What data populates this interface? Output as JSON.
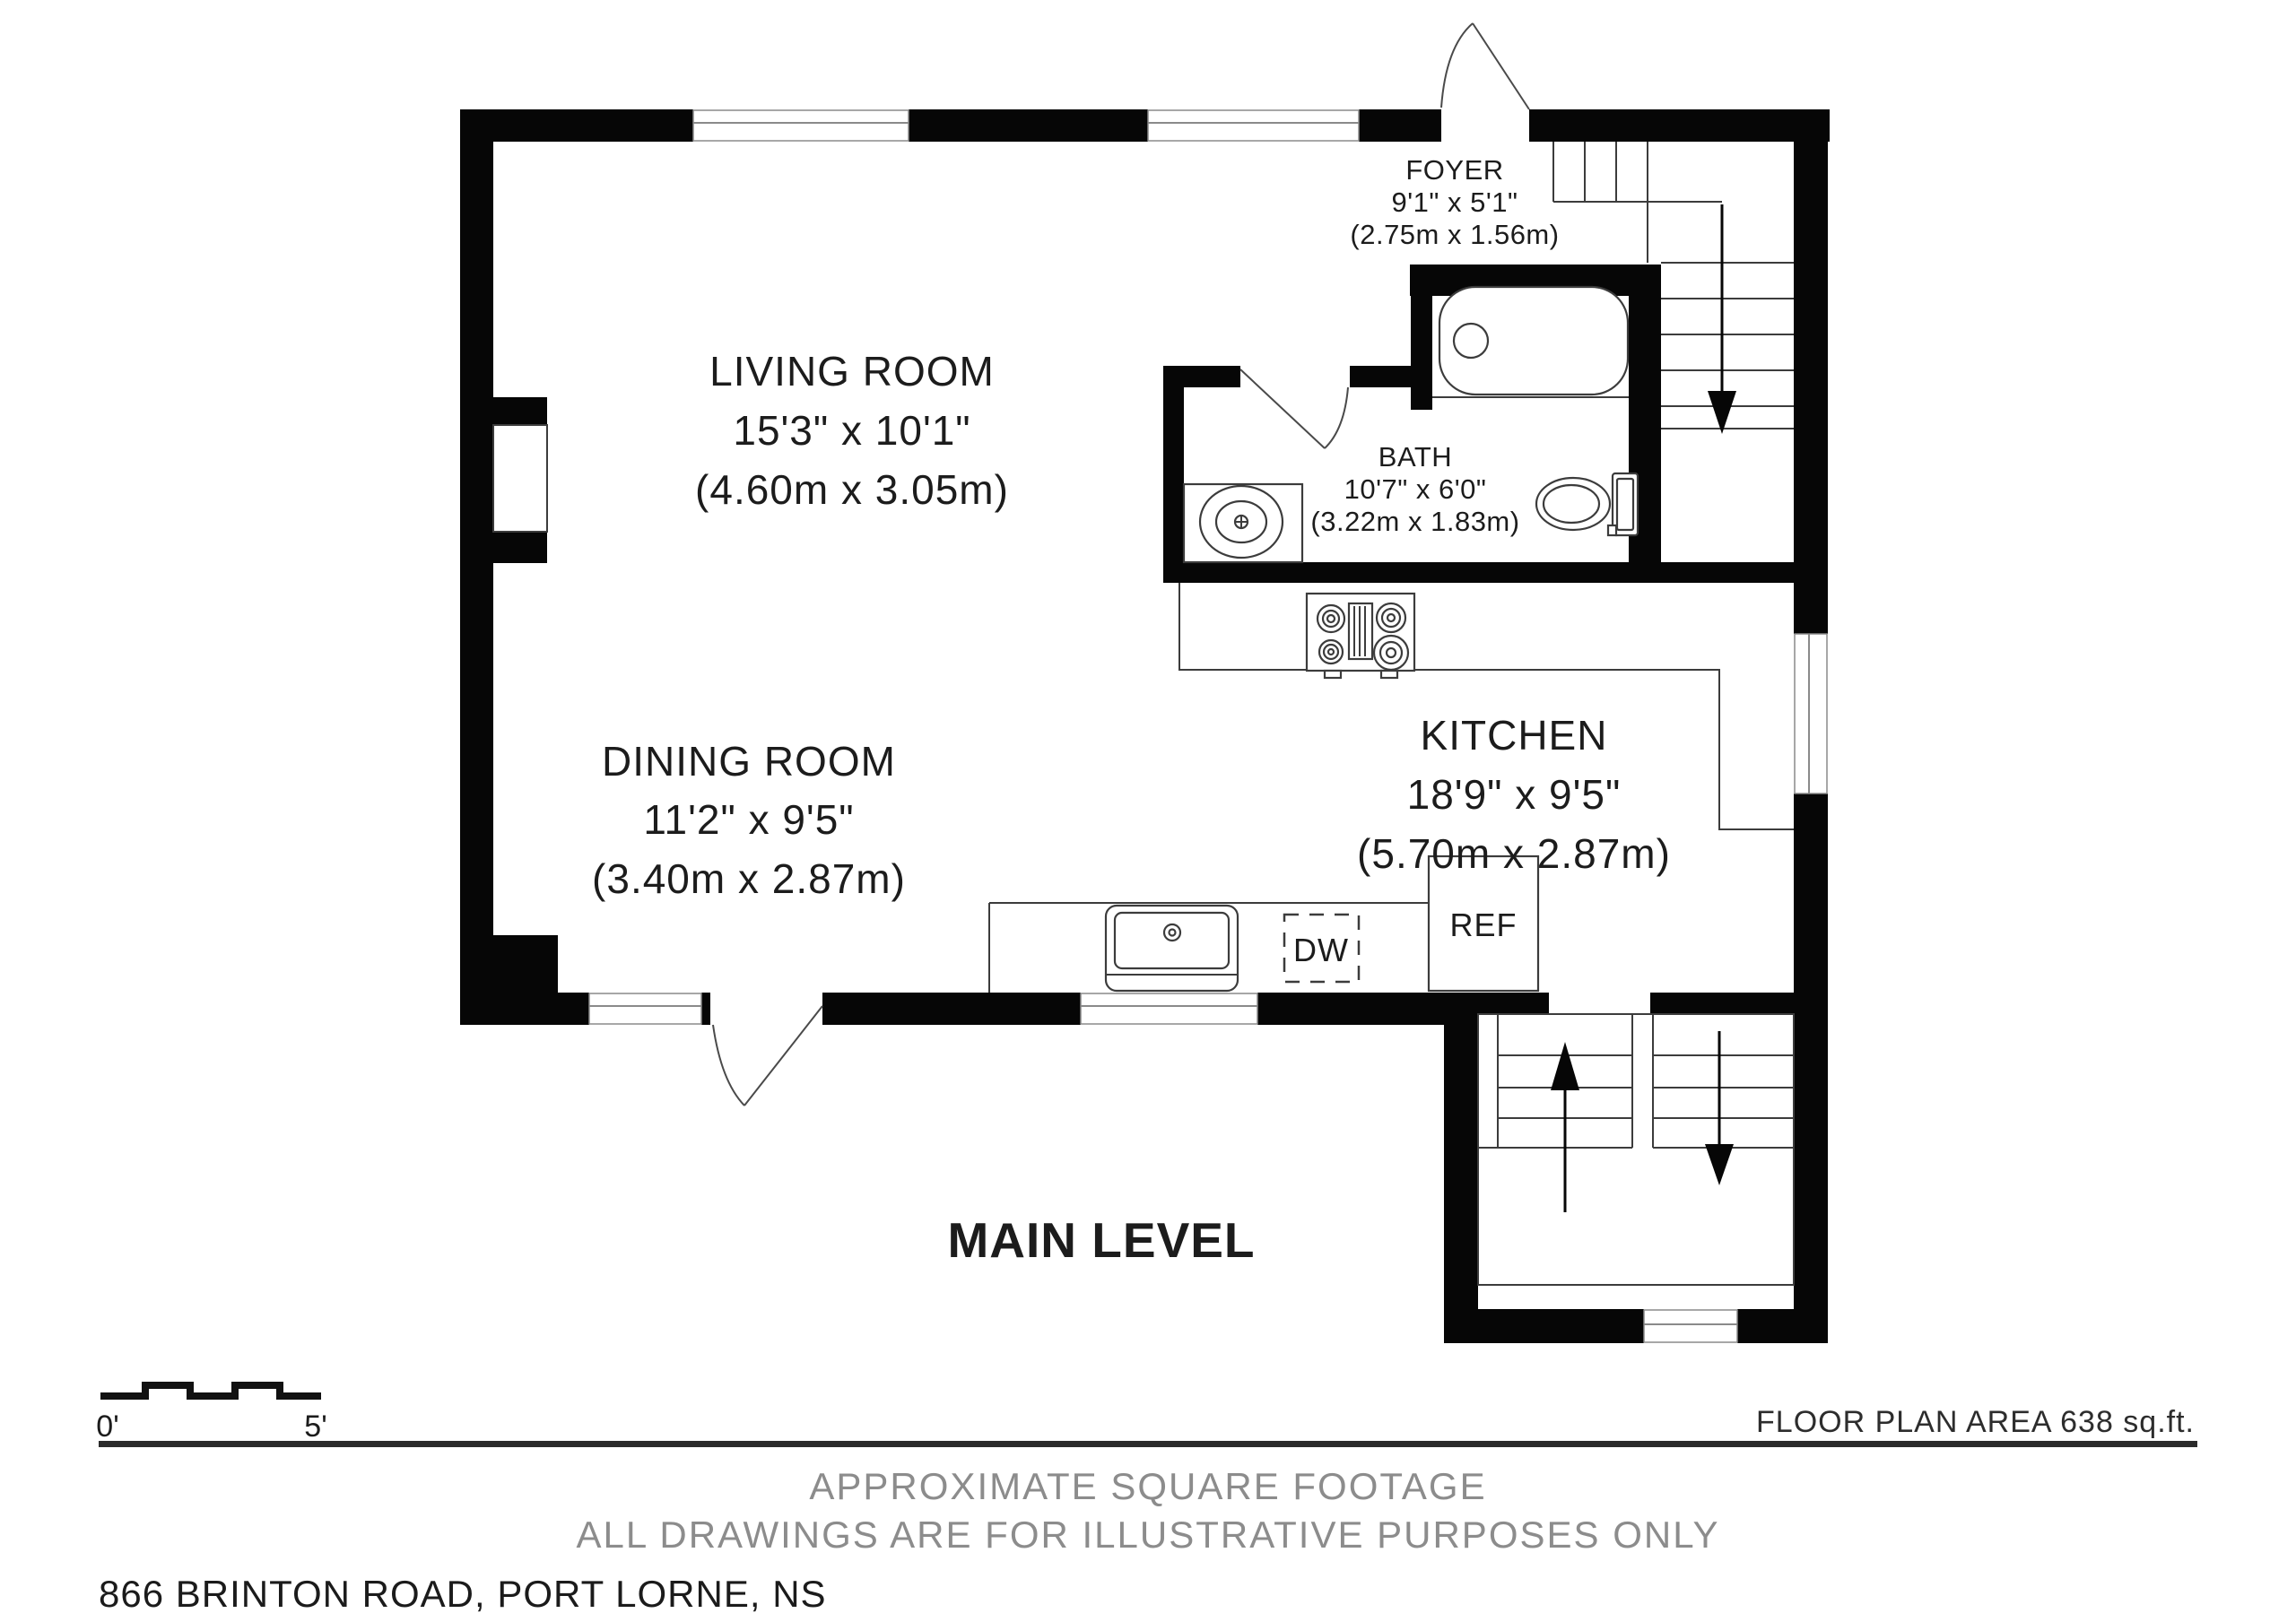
{
  "plan": {
    "level_label": "MAIN LEVEL",
    "area_note": "FLOOR PLAN AREA 638 sq.ft.",
    "disclaimer_line1": "APPROXIMATE SQUARE FOOTAGE",
    "disclaimer_line2": "ALL DRAWINGS ARE FOR ILLUSTRATIVE PURPOSES ONLY",
    "address": "866 BRINTON ROAD, PORT LORNE, NS",
    "scale": {
      "start_label": "0'",
      "end_label": "5'"
    }
  },
  "rooms": [
    {
      "name": "LIVING ROOM",
      "imperial": "15'3\" x 10'1\"",
      "metric": "(4.60m x 3.05m)"
    },
    {
      "name": "FOYER",
      "imperial": "9'1\" x 5'1\"",
      "metric": "(2.75m x 1.56m)"
    },
    {
      "name": "BATH",
      "imperial": "10'7\" x 6'0\"",
      "metric": "(3.22m x 1.83m)"
    },
    {
      "name": "KITCHEN",
      "imperial": "18'9\" x 9'5\"",
      "metric": "(5.70m x 2.87m)"
    },
    {
      "name": "DINING ROOM",
      "imperial": "11'2\" x 9'5\"",
      "metric": "(3.40m x 2.87m)"
    }
  ],
  "appliances": {
    "dishwasher": "DW",
    "refrigerator": "REF"
  },
  "colors": {
    "wall": "#060606",
    "line": "#3c3c3c",
    "muted_text": "#8c8c8c",
    "text": "#1c1c1c"
  }
}
